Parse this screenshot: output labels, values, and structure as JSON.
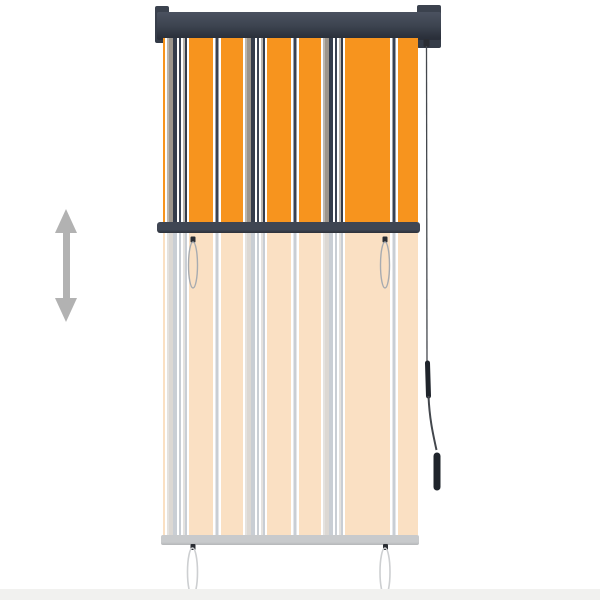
{
  "scene": {
    "subject": "striped vertical roller blind product photo",
    "background": "#FFFFFF"
  },
  "colors": {
    "background": "#FFFFFF",
    "floor": "#F1F1EF",
    "arrow": "#B2B2B2",
    "cassette_top": "#4B5260",
    "cassette_mid": "#3C434F",
    "cassette_bottom": "#2A2F3A",
    "cassette_cap": "#343B47",
    "middle_rail": "#3F4653",
    "middle_rail_edge": "#2C3039",
    "bottom_rail": "#C8CACC",
    "bottom_rail_edge": "#B5B7B9",
    "cord": "#1F242B",
    "cord_thin": "#43474D",
    "loop_upper": "#A7ABB0",
    "loop_lower": "#CDCFD1",
    "hook": "#2A2D33"
  },
  "blind": {
    "stripe_unit_px": 78,
    "stripe_offset_px": -52,
    "stripes_vivid": [
      {
        "c": "#F7941E",
        "w": 24
      },
      {
        "c": "#FEFEFE",
        "w": 2.5
      },
      {
        "c": "#3A4252",
        "w": 3
      },
      {
        "c": "#FEFEFE",
        "w": 2.5
      },
      {
        "c": "#F7941E",
        "w": 22
      },
      {
        "c": "#FEFEFE",
        "w": 2
      },
      {
        "c": "#BAB6B0",
        "w": 2
      },
      {
        "c": "#9C958C",
        "w": 4
      },
      {
        "c": "#343C4B",
        "w": 4
      },
      {
        "c": "#FEFEFE",
        "w": 2
      },
      {
        "c": "#3A4252",
        "w": 2
      },
      {
        "c": "#FEFEFE",
        "w": 2
      },
      {
        "c": "#BAB6B0",
        "w": 2
      },
      {
        "c": "#343C4B",
        "w": 2
      },
      {
        "c": "#FEFEFE",
        "w": 2
      }
    ],
    "stripes_faded": [
      {
        "c": "#FAE0C3",
        "w": 24
      },
      {
        "c": "#FFFFFF",
        "w": 2.5
      },
      {
        "c": "#C9CED4",
        "w": 3
      },
      {
        "c": "#FFFFFF",
        "w": 2.5
      },
      {
        "c": "#FAE0C3",
        "w": 22
      },
      {
        "c": "#FFFFFF",
        "w": 2
      },
      {
        "c": "#E4E2DF",
        "w": 2
      },
      {
        "c": "#DCD8D3",
        "w": 4
      },
      {
        "c": "#C9CED4",
        "w": 4
      },
      {
        "c": "#FFFFFF",
        "w": 2
      },
      {
        "c": "#C9CED4",
        "w": 2
      },
      {
        "c": "#FFFFFF",
        "w": 2
      },
      {
        "c": "#E4E2DF",
        "w": 2
      },
      {
        "c": "#C9CED4",
        "w": 2
      },
      {
        "c": "#FFFFFF",
        "w": 2
      }
    ]
  }
}
